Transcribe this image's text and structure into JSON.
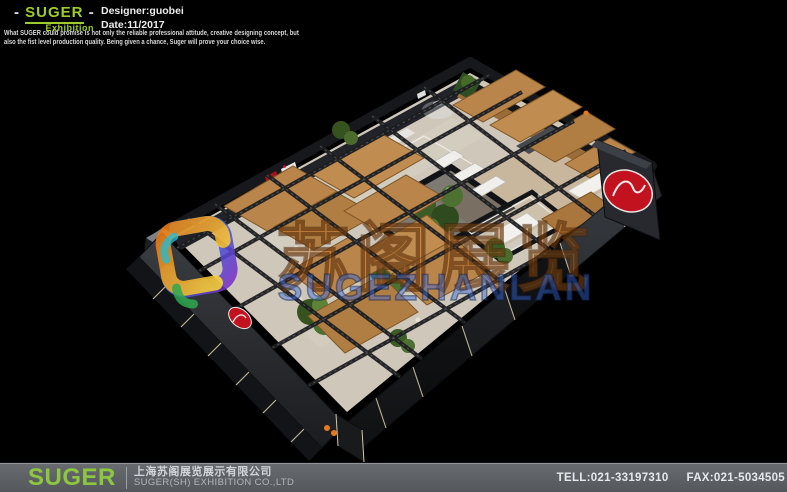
{
  "header": {
    "brand": {
      "dash_left": "-",
      "name": "SUGER",
      "dash_right": "-",
      "subtitle": "Exhibition"
    },
    "designer": "Designer:guobei",
    "date": "Date:11/2017",
    "description": "What SUGER could promise is not only the reliable professional attitude, creative designing concept, but also the fist level production quality. Being given a chance, Suger will prove your choice wise."
  },
  "watermark": {
    "cn": "苏阁展览",
    "latin": "SUGEZHANLAN"
  },
  "booth": {
    "view": "3D aerial render of exhibition hall",
    "colors": {
      "wood_panel": "#b9854a",
      "floor": "#cfc8ba",
      "truss": "#1c1d20",
      "plants": "#47682c",
      "wall": "#26282c",
      "accent_red": "#c3121f",
      "accent_orange": "#e57a1d"
    }
  },
  "footer": {
    "brand": "SUGER",
    "company_cn": "上海苏阁展览展示有限公司",
    "company_en": "SUGER(SH) EXHIBITION CO.,LTD",
    "tel": "TELL:021-33197310",
    "fax": "FAX:021-5034505"
  }
}
